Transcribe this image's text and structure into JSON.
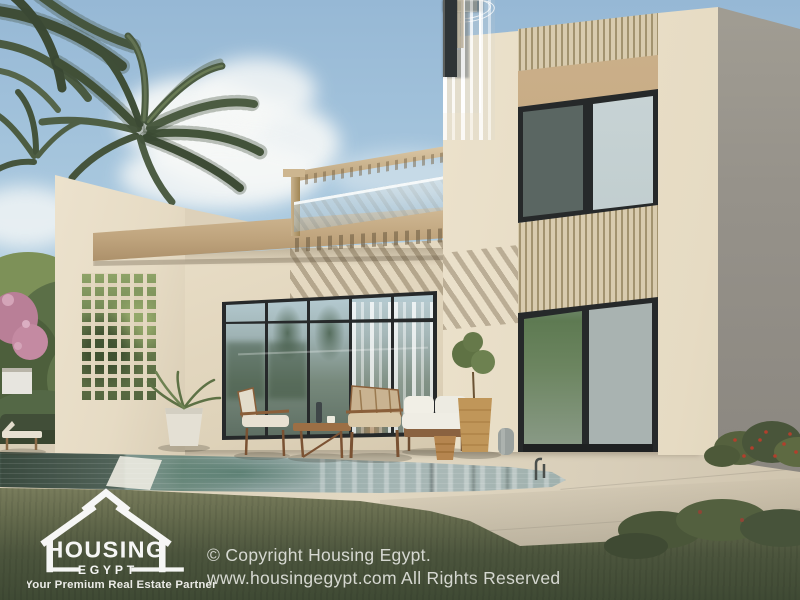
{
  "watermark": {
    "logo": {
      "icon": "house-outline-icon",
      "title": "HOUSING",
      "subtitle": "EGYPT",
      "tagline": "Your Premium Real Estate Partner"
    },
    "copyright": {
      "line1": "© Copyright Housing Egypt.",
      "line2": "www.housingegypt.com All Rights Reserved"
    }
  },
  "colors": {
    "sky_top": "#96b8d5",
    "sky_mid": "#aac9df",
    "sky_low": "#ccdde7",
    "cloud": "#f6f8f7",
    "stucco": "#ebe1cb",
    "stucco_dark": "#d9cdb4",
    "wood": "#c5ab85",
    "slat_light": "#d8cbae",
    "slat_dark": "#a2936f",
    "frame": "#26292a",
    "curtain": "#f2f3f1",
    "deck": "#ddd3be",
    "pool_light": "#a9b8b6",
    "pool_dark": "#53685e",
    "grass": "#6d7254",
    "grass_dark": "#3f4a34",
    "palm": "#4a5940",
    "tree": "#5f7349",
    "flower_red": "#ab3f2e",
    "shade_face": "#96928a",
    "watermark": "#f0f1ee"
  }
}
